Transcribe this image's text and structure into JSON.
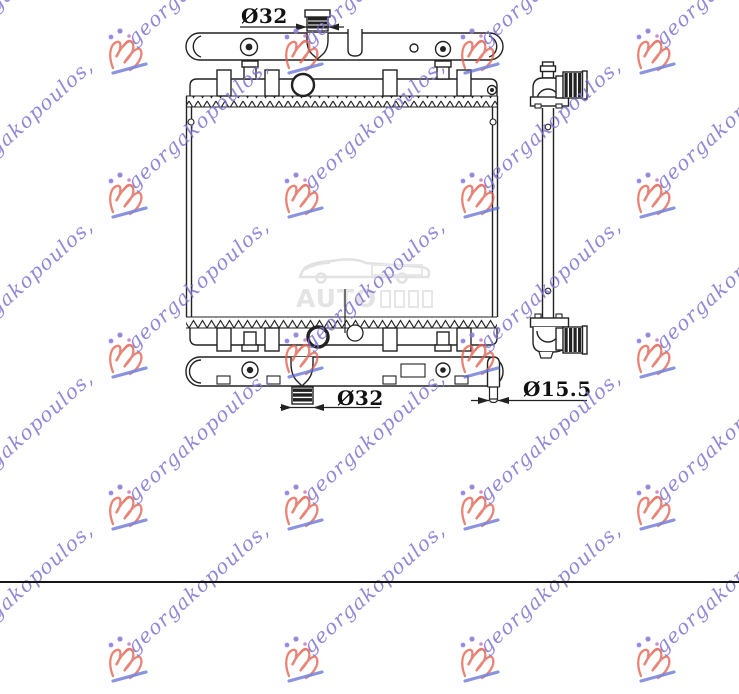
{
  "dimensions": {
    "top_inlet_label": "Ø32",
    "bottom_outlet_label": "Ø32",
    "drain_label": "Ø15.5"
  },
  "watermark": {
    "text": "georgakopoulos,",
    "text_color": "#7f74d2",
    "logo_color": "#e0604f",
    "underline_color": "#5b6bd5",
    "dot_color": "#8a7ad8",
    "grid_cols": [
      -72,
      104,
      280,
      456,
      632
    ],
    "grid_rows": [
      26,
      170,
      330,
      482,
      634
    ]
  },
  "center_watermark": {
    "text": "AUTO",
    "color": "#cfcfcf"
  },
  "drawing": {
    "stroke_color": "#222222"
  }
}
